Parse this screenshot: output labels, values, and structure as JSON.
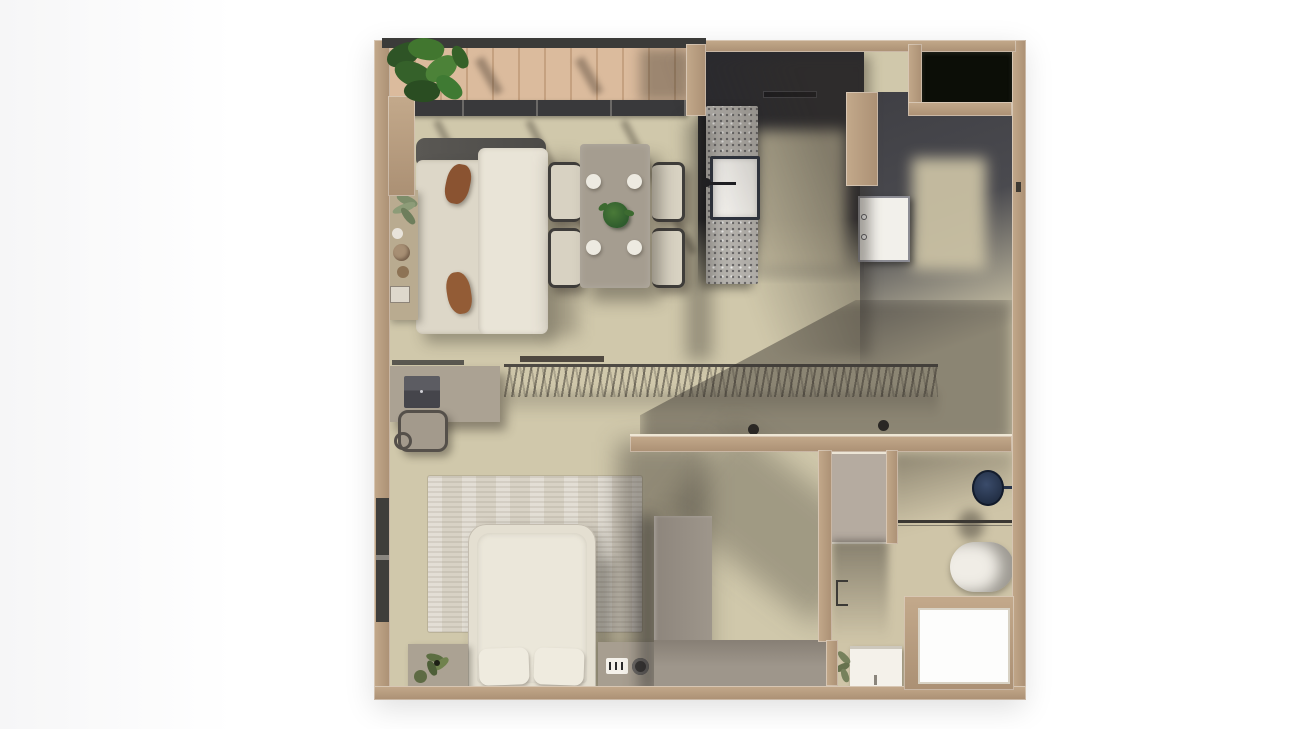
{
  "scene": {
    "title": "One-bedroom apartment 3D top-down floor plan render",
    "background": "#ffffff"
  },
  "palette": {
    "wall_tan": "#b2987c",
    "floor_beige": "#d0c8ab",
    "deck_wood": "#d6b290",
    "kitchen_dark": "#2a2a2f",
    "hall_grey": "#47474c",
    "closet_dark": "#0c0e07",
    "sofa_cream": "#e0dbcd",
    "pillow_brown": "#8a5331",
    "table_taupe": "#a59d90",
    "plant_green": "#3f6b33",
    "rug_beige": "#d8d2c5",
    "bed_cream": "#e4dfd1",
    "wardrobe_grey": "#9a9186",
    "island_terrazzo": "#b5b2ad",
    "door_white": "#f2f0eb",
    "basin_navy": "#2c3a52",
    "tub_white": "#f0ede6",
    "shower_white": "#fdfdfc"
  },
  "rooms": {
    "balcony": {
      "name": "Balcony",
      "items": [
        "potted-plant",
        "wood-deck",
        "railing",
        "sliding-door-track"
      ]
    },
    "living_room": {
      "name": "Living room",
      "items": [
        "sofa",
        "brown-cushions",
        "console-table",
        "plant",
        "vases"
      ]
    },
    "dining_area": {
      "name": "Dining area",
      "items": [
        "dining-table",
        "four-chairs",
        "four-plates",
        "centerpiece-plant"
      ]
    },
    "kitchen": {
      "name": "Kitchen",
      "items": [
        "terrazzo-island",
        "sink",
        "faucet",
        "cooktop",
        "dark-cabinets"
      ]
    },
    "entry_hall": {
      "name": "Entry hall",
      "items": [
        "interior-door",
        "dark-floor"
      ]
    },
    "utility_closet": {
      "name": "Utility closet",
      "items": [
        "dark-interior"
      ]
    },
    "corridor": {
      "name": "Corridor",
      "items": [
        "desk",
        "laptop",
        "desk-chair",
        "open-wardrobe-rail",
        "hangers",
        "two-stools"
      ]
    },
    "bedroom": {
      "name": "Bedroom",
      "items": [
        "double-bed",
        "two-pillows",
        "area-rug",
        "nightstand-left",
        "nightstand-right",
        "alarm-clock",
        "speaker",
        "plants",
        "l-shaped-wardrobe",
        "window"
      ]
    },
    "walk_in_closet": {
      "name": "Walk-in closet",
      "items": [
        "floor-panel",
        "door-jamb"
      ]
    },
    "bathroom": {
      "name": "Bathroom",
      "items": [
        "navy-basin",
        "glass-screen",
        "bathtub",
        "vanity-sink",
        "plant",
        "shower-room"
      ]
    }
  }
}
